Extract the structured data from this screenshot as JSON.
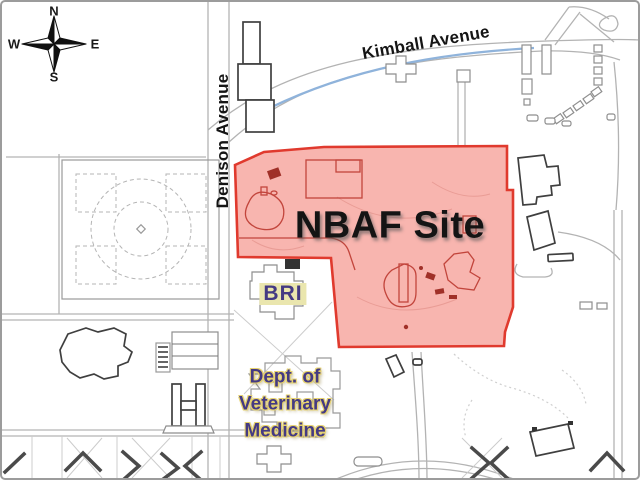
{
  "map": {
    "compass": {
      "north": "N",
      "west": "W",
      "east": "E",
      "south": "S"
    },
    "labels": {
      "kimball_avenue": "Kimball Avenue",
      "denison_avenue": "Denison Avenue",
      "nbaf_site": "NBAF Site",
      "bri": "BRI",
      "dept_vet": {
        "line1": "Dept. of",
        "line2": "Veterinary",
        "line3": "Medicine"
      }
    }
  },
  "colors": {
    "site-fill": "#F26B60",
    "site-stroke": "#E03A2E",
    "site-inner": "#C2453C",
    "road-blue": "#8FB3DB",
    "label-purple": "#443A83",
    "label-highlight": "#EAE6AE",
    "label-glow": "#E6D26E",
    "ink": "#151515"
  }
}
